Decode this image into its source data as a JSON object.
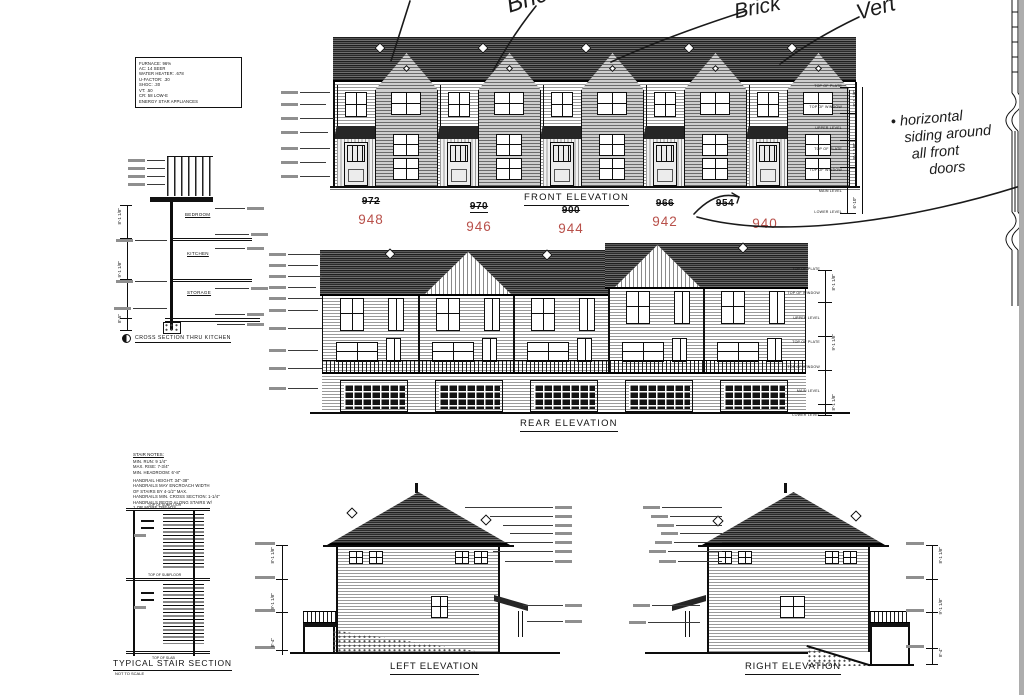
{
  "palette": {
    "ink": "#111111",
    "red": "#b8504a",
    "paper": "#ffffff",
    "page_edge": "#adadad"
  },
  "spec_box": {
    "lines": [
      "FURNACE: 96%",
      "AC: 14 SEER",
      "WATER HEATER: .678",
      "U-FACTOR: .30",
      "SHGC: .30",
      "VT: .50",
      "CR: 58 LOW-E",
      "ENERGY STAR APPLIANCES"
    ]
  },
  "cross_section": {
    "title": "CROSS SECTION THRU KITCHEN",
    "rooms": [
      "BEDROOM",
      "KITCHEN",
      "STORAGE"
    ],
    "dims": [
      "8'-1 1/8\"",
      "9'-1 1/8\"",
      "8'-5\""
    ]
  },
  "front_elevation": {
    "title": "FRONT ELEVATION",
    "units": [
      {
        "old": "972",
        "new": "948"
      },
      {
        "old": "970",
        "new": "946"
      },
      {
        "old": "900",
        "new": "944"
      },
      {
        "old": "966",
        "new": "942"
      },
      {
        "old": "954",
        "new": "940"
      }
    ],
    "dim_labels": [
      "TOP OF PLATE",
      "TOP OF WINDOW",
      "UPPER LEVEL",
      "TOP OF PLATE",
      "TOP OF WINDOW",
      "MAIN LEVEL",
      "LOWER LEVEL"
    ],
    "dims": [
      "8'-1 1/8\"",
      "9'-1 1/8\"",
      "6'-10\""
    ]
  },
  "rear_elevation": {
    "title": "REAR ELEVATION",
    "dim_labels": [
      "TOP OF PLATE",
      "TOP OF WINDOW",
      "UPPER LEVEL",
      "TOP OF PLATE",
      "TOP OF WINDOW",
      "MAIN LEVEL",
      "LOWER LEVEL"
    ],
    "dims": [
      "8'-1 1/8\"",
      "9'-1 1/8\"",
      "8'-1 1/8\""
    ]
  },
  "left_elevation": {
    "title": "LEFT ELEVATION",
    "dims": [
      "8'-1 1/8\"",
      "9'-1 1/8\"",
      "8'-4\""
    ]
  },
  "right_elevation": {
    "title": "RIGHT ELEVATION",
    "dims": [
      "8'-1 1/8\"",
      "9'-1 1/8\"",
      "8'-4\""
    ]
  },
  "stair_section": {
    "title": "TYPICAL STAIR SECTION",
    "subtitle": "NOT TO SCALE",
    "notes_title": "STAIR NOTES:",
    "notes": [
      "MIN. RUN: 9 1/4\"",
      "MAX. RISE: 7-3/4\"",
      "MIN. HEADROOM: 6'-8\""
    ],
    "handrail_notes": [
      "HANDRAIL HEIGHT: 34\"-38\"",
      "HANDRAILS MAY ENCROACH WIDTH",
      "OF STAIRS BY 4-1/2\" MAX.",
      "HANDRAILS MIN. CROSS SECTION: 1-1/4\"",
      "HANDRAILS REQ'D ALONG STAIRS W/",
      "1 OR MORE TREADS"
    ],
    "level_labels": [
      "TOP OF SUBFLOOR",
      "TOP OF SUBFLOOR",
      "TOP OF SLAB"
    ]
  },
  "annotations": {
    "handwriting": [
      {
        "text": "Brick"
      },
      {
        "text": "Brick"
      },
      {
        "text": "Vert"
      }
    ],
    "note_lines": [
      "• horizontal",
      "siding around",
      "all front",
      "doors"
    ]
  }
}
